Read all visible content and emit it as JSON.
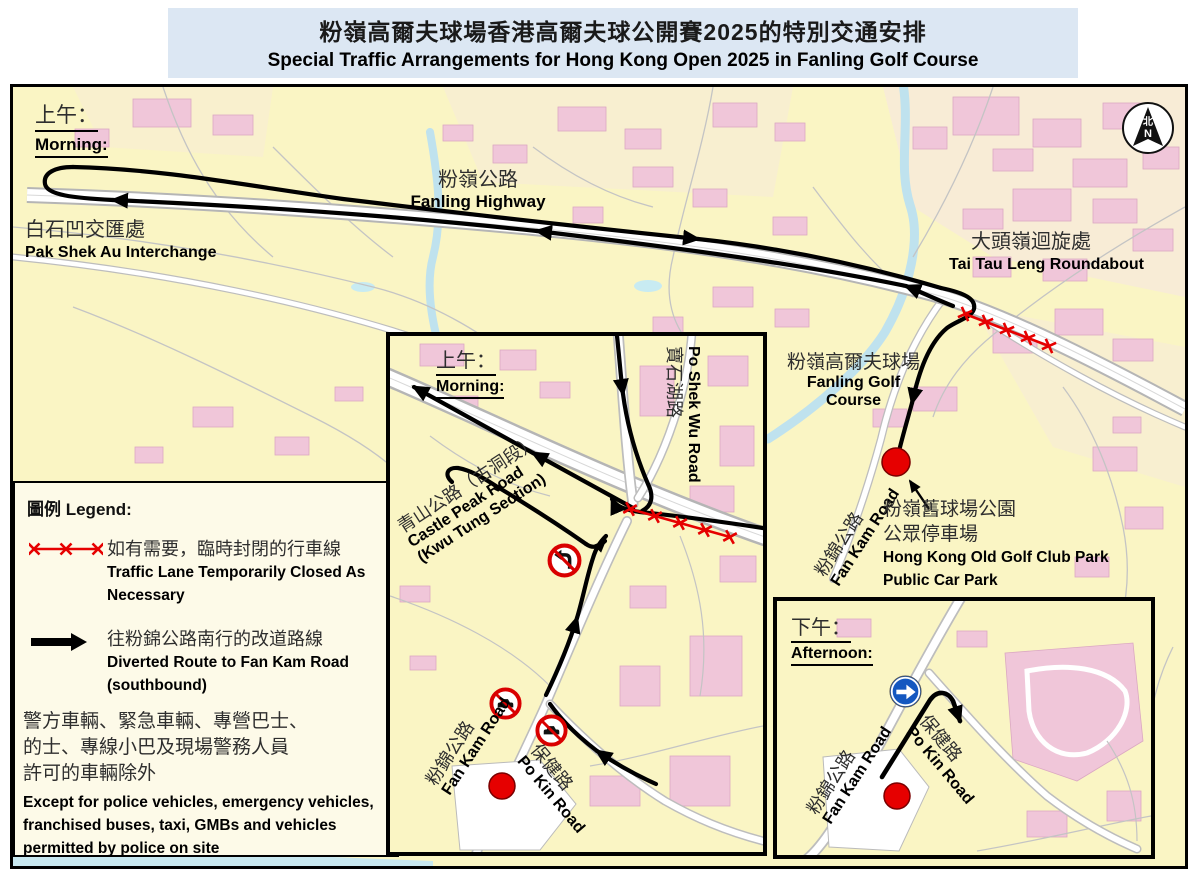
{
  "title": {
    "line1_zh": "粉嶺高爾夫球場香港高爾夫球公開賽2025的特別交通安排",
    "line2_en": "Special Traffic Arrangements for Hong Kong Open 2025 in Fanling Golf Course"
  },
  "main_map": {
    "period_zh": "上午：",
    "period_en": "Morning:",
    "pak_shek_au_zh": "白石凹交匯處",
    "pak_shek_au_en": "Pak Shek Au Interchange",
    "fanling_highway_zh": "粉嶺公路",
    "fanling_highway_en": "Fanling Highway",
    "tai_tau_leng_zh": "大頭嶺迴旋處",
    "tai_tau_leng_en": "Tai Tau Leng Roundabout",
    "golf_course_zh": "粉嶺高爾夫球場",
    "golf_course_en1": "Fanling Golf",
    "golf_course_en2": "Course",
    "fan_kam_zh": "粉錦公路",
    "fan_kam_en": "Fan Kam Road",
    "car_park_zh1": "粉嶺舊球場公園",
    "car_park_zh2": "公眾停車場",
    "car_park_en1": "Hong Kong Old Golf Club Park",
    "car_park_en2": "Public Car Park",
    "compass_zh": "北",
    "compass_en": "N"
  },
  "legend": {
    "heading": "圖例 Legend:",
    "items": [
      {
        "symbol": "closed-lane-x-line",
        "color": "#E60000",
        "zh": "如有需要，臨時封閉的行車線",
        "en": "Traffic Lane Temporarily Closed As Necessary"
      },
      {
        "symbol": "black-diversion-arrow",
        "color": "#000000",
        "zh": "往粉錦公路南行的改道路線",
        "en": "Diverted Route to Fan Kam Road (southbound)"
      }
    ],
    "exception_zh1": "警方車輛、緊急車輛、專營巴士、",
    "exception_zh2": "的士、專線小巴及現場警務人員",
    "exception_zh3": "許可的車輛除外",
    "exception_en": "Except for police vehicles, emergency vehicles, franchised buses, taxi, GMBs and vehicles permitted by police on site"
  },
  "inset_morning": {
    "period_zh": "上午：",
    "period_en": "Morning:",
    "po_shek_wu_zh": "寶石湖路",
    "po_shek_wu_en": "Po Shek Wu Road",
    "castle_peak_zh": "青山公路（古洞段）",
    "castle_peak_en1": "Castle Peak Road",
    "castle_peak_en2": "(Kwu Tung Section)",
    "fan_kam_zh": "粉錦公路",
    "fan_kam_en": "Fan Kam Road",
    "po_kin_zh": "保健路",
    "po_kin_en": "Po Kin Road"
  },
  "inset_afternoon": {
    "period_zh": "下午：",
    "period_en": "Afternoon:",
    "fan_kam_zh": "粉錦公路",
    "fan_kam_en": "Fan Kam Road",
    "po_kin_zh": "保健路",
    "po_kin_en": "Po Kin Road"
  },
  "icons": {
    "compass": "north-arrow",
    "closed_lane": "red-x-line",
    "diversion": "black-arrow",
    "no_turn_sign": "no-left-turn-prohibition",
    "no_vehicles_sign": "no-motor-vehicles-prohibition",
    "mandatory_turn_sign": "turn-right-mandatory",
    "car_park_marker": "red-dot"
  },
  "colors": {
    "title_bg": "#DCE7F3",
    "map_bg": "#FAF5C4",
    "building_pink": "#F2CBDC",
    "water_blue": "#BFE2EE",
    "route_black": "#000000",
    "closed_lane_red": "#E60000",
    "prohibition_red": "#D90000",
    "mandatory_sign_blue": "#1457C0",
    "red_dot": "#E60000"
  }
}
